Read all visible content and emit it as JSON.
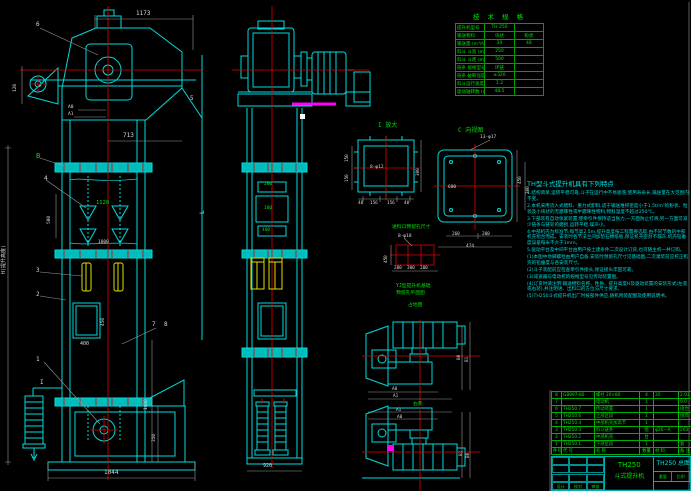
{
  "spec": {
    "title": "技 术 规 格",
    "rows": [
      [
        "提升机型号",
        "TH 250",
        ""
      ],
      [
        "输送物料",
        "块状",
        "粉状"
      ],
      [
        "输送量 (m³/h)",
        "30",
        "48"
      ],
      [
        "料斗 斗宽 (mm)",
        "250",
        ""
      ],
      [
        "料斗 斗距 (mm)",
        "500",
        ""
      ],
      [
        "链条 规格型号",
        "环链",
        ""
      ],
      [
        "链条 破断强度 (kN)",
        "≥320",
        ""
      ],
      [
        "料斗运行速度 (m/s)",
        "1.2",
        ""
      ],
      [
        "驱动轴转数 (r/min)",
        "48.5",
        ""
      ]
    ]
  },
  "notes": {
    "title": "TH型斗式提升机具有下列特点",
    "lines": [
      "1.结构简单,运转平稳可靠,斗子在运行中不易脱落,使用寿命长,输送量在大范围内不变。",
      "2.本机采用流入式喂料、重力式卸料,适于输送堆积密度小于1.5t/m³的粉状、粒状及小块状的无磨琢性或半磨琢性物料,物料温度不超过250℃。",
      "3.下部装有自动张紧装置,使牵引件保持适当张力,一方面防止打滑,另一方面可减少链条与链轮的磨损,运转平稳,噪声小。",
      "4.中部机壳为标准节,每节高2.5m,提升高度按工程需要选取,由不同节数的中部机壳组合而成。安装时各节法兰间加垫石棉纸板,保证机壳密封不漏灰,机壳铅垂度误差每米不大于1mm。",
      "5.驱动平台及中间平台由用户按土建条件二次设计订货,也可随主机一并订购。",
      "(1)本图中地脚螺栓由用户自备,安装时预留孔尺寸见基础图,二次灌浆前应校正机壳的铅垂度与各安装尺寸。",
      "(2)斗子装配前应检查牵引件接头,保证接头牢固可靠。",
      "(3)减速器与电动机的规格型号见传动装置图。",
      "(4)订货时请注明:输送物料名称、性质、提升高度H及驱动装置的安装形式(左装或右装),并注明进、出料口的方位与尺寸要求。",
      "(5)TH250斗式提升机出厂时按部件供应,随机附装配图及使用说明书。"
    ]
  },
  "bom": {
    "rows": [
      [
        "8",
        "GB897-86",
        "螺柱 20×80",
        "4",
        "35",
        "2.03"
      ],
      [
        "7",
        "",
        "电动机",
        "1",
        "",
        "9.0"
      ],
      [
        "6",
        "TH250.7",
        "传动装置",
        "1",
        "",
        "组合"
      ],
      [
        "5",
        "TH250.6",
        "上部区段",
        "1",
        "",
        "组焊"
      ],
      [
        "4",
        "TH250.4",
        "中部机壳加高节",
        "1",
        "",
        ""
      ],
      [
        "3",
        "TH250.3",
        "料斗链条",
        "组",
        "φ26—A",
        "203"
      ],
      [
        "2",
        "TH250.2",
        "中部机壳",
        "台",
        "",
        ""
      ],
      [
        "1",
        "TH250.1",
        "下部区段",
        "1",
        "",
        "套"
      ],
      [
        "件号",
        "代 号",
        "名 称",
        "数量",
        "材 料",
        "备 注"
      ]
    ]
  },
  "title_block": {
    "model": "TH250",
    "name": "斗式提升机",
    "drawing_no": "TH250 总图",
    "sign_labels": [
      "设计",
      "校对",
      "审核"
    ],
    "weight_label": "重量",
    "scale_label": "比例"
  },
  "annotations": [
    {
      "t": "6",
      "x": 36,
      "y": 22,
      "s": 6
    },
    {
      "t": "1173",
      "x": 136,
      "y": 11,
      "s": 6
    },
    {
      "t": "120",
      "x": 14,
      "y": 92,
      "s": 4.5,
      "r": -90
    },
    {
      "t": "A0",
      "x": 68,
      "y": 106,
      "s": 4.5
    },
    {
      "t": "A1",
      "x": 68,
      "y": 113,
      "s": 4.5
    },
    {
      "t": "713",
      "x": 123,
      "y": 133,
      "s": 6
    },
    {
      "t": "5",
      "x": 190,
      "y": 96,
      "s": 6
    },
    {
      "t": "B",
      "x": 36,
      "y": 153,
      "s": 7,
      "c": "#00e000"
    },
    {
      "t": "4",
      "x": 44,
      "y": 176,
      "s": 6
    },
    {
      "t": "500",
      "x": 48,
      "y": 224,
      "s": 4.5,
      "r": -90
    },
    {
      "t": "1120",
      "x": 96,
      "y": 201,
      "s": 5.5,
      "c": "#00e000"
    },
    {
      "t": "1000",
      "x": 98,
      "y": 241,
      "s": 4.5
    },
    {
      "t": "3",
      "x": 36,
      "y": 268,
      "s": 6
    },
    {
      "t": "2",
      "x": 36,
      "y": 292,
      "s": 6
    },
    {
      "t": "L",
      "x": 200,
      "y": 214,
      "s": 6,
      "r": -90
    },
    {
      "t": "H(提升高度)",
      "x": 2,
      "y": 274,
      "s": 5,
      "r": -90
    },
    {
      "t": "400",
      "x": 80,
      "y": 342,
      "s": 5
    },
    {
      "t": "450",
      "x": 102,
      "y": 326,
      "s": 4.5,
      "r": -90
    },
    {
      "t": "7",
      "x": 152,
      "y": 322,
      "s": 6
    },
    {
      "t": "8",
      "x": 164,
      "y": 322,
      "s": 6
    },
    {
      "t": "1",
      "x": 36,
      "y": 357,
      "s": 6
    },
    {
      "t": "I",
      "x": 40,
      "y": 380,
      "s": 6
    },
    {
      "t": "1400",
      "x": 145,
      "y": 410,
      "s": 4.5,
      "r": -90
    },
    {
      "t": "350",
      "x": 153,
      "y": 442,
      "s": 4.5,
      "r": -90
    },
    {
      "t": "1044",
      "x": 104,
      "y": 470,
      "s": 6
    },
    {
      "t": "260",
      "x": 264,
      "y": 183,
      "s": 4.5,
      "c": "#00e000"
    },
    {
      "t": "180",
      "x": 264,
      "y": 207,
      "s": 4.5,
      "c": "#00e000"
    },
    {
      "t": "400",
      "x": 262,
      "y": 229,
      "s": 4.5,
      "c": "#00e000"
    },
    {
      "t": "920",
      "x": 263,
      "y": 464,
      "s": 5
    },
    {
      "t": "I 放大",
      "x": 378,
      "y": 123,
      "s": 6,
      "c": "#00e000"
    },
    {
      "t": "8-φ12",
      "x": 370,
      "y": 166,
      "s": 4.5
    },
    {
      "t": "150",
      "x": 346,
      "y": 162,
      "s": 4.3,
      "r": -90
    },
    {
      "t": "150",
      "x": 346,
      "y": 182,
      "s": 4.3,
      "r": -90
    },
    {
      "t": "300",
      "x": 417,
      "y": 176,
      "s": 4.3,
      "r": -90
    },
    {
      "t": "40",
      "x": 358,
      "y": 202,
      "s": 4.3
    },
    {
      "t": "156",
      "x": 370,
      "y": 202,
      "s": 4.3
    },
    {
      "t": "156",
      "x": 387,
      "y": 202,
      "s": 4.3
    },
    {
      "t": "40",
      "x": 404,
      "y": 202,
      "s": 4.3
    },
    {
      "t": "C 向视图",
      "x": 458,
      "y": 128,
      "s": 6,
      "c": "#00e000"
    },
    {
      "t": "13-φ17",
      "x": 480,
      "y": 136,
      "s": 4.5
    },
    {
      "t": "600",
      "x": 448,
      "y": 186,
      "s": 4.5
    },
    {
      "t": "450",
      "x": 519,
      "y": 184,
      "s": 4.3,
      "r": -90
    },
    {
      "t": "300",
      "x": 527,
      "y": 194,
      "s": 4.3,
      "r": -90
    },
    {
      "t": "260",
      "x": 452,
      "y": 233,
      "s": 4.3
    },
    {
      "t": "200",
      "x": 482,
      "y": 233,
      "s": 4.3
    },
    {
      "t": "474",
      "x": 466,
      "y": 245,
      "s": 4.5
    },
    {
      "t": "进料口预留孔尺寸",
      "x": 392,
      "y": 226,
      "s": 4.8,
      "c": "#00e000"
    },
    {
      "t": "8-φ18",
      "x": 398,
      "y": 235,
      "s": 4.5
    },
    {
      "t": "450",
      "x": 385,
      "y": 263,
      "s": 4.3,
      "r": -90
    },
    {
      "t": "200",
      "x": 394,
      "y": 267,
      "s": 4.3
    },
    {
      "t": "300",
      "x": 407,
      "y": 267,
      "s": 4.3
    },
    {
      "t": "200",
      "x": 420,
      "y": 267,
      "s": 4.3
    },
    {
      "t": "YJ型提升机基础",
      "x": 396,
      "y": 285,
      "s": 4.8,
      "c": "#00e000"
    },
    {
      "t": "预留孔平面图",
      "x": 396,
      "y": 292,
      "s": 4.8,
      "c": "#00e000"
    },
    {
      "t": "占地图",
      "x": 408,
      "y": 304,
      "s": 4.8,
      "c": "#00e000"
    },
    {
      "t": "B0",
      "x": 458,
      "y": 360,
      "s": 4.3,
      "r": -90
    },
    {
      "t": "B1",
      "x": 466,
      "y": 362,
      "s": 4.3,
      "r": -90
    },
    {
      "t": "A0",
      "x": 392,
      "y": 388,
      "s": 4.3
    },
    {
      "t": "A1",
      "x": 393,
      "y": 395,
      "s": 4.3
    },
    {
      "t": "右装",
      "x": 413,
      "y": 403,
      "s": 4.8,
      "c": "#00e000"
    },
    {
      "t": "A1",
      "x": 396,
      "y": 409,
      "s": 4.3
    },
    {
      "t": "A0",
      "x": 397,
      "y": 416,
      "s": 4.3
    },
    {
      "t": "B1",
      "x": 460,
      "y": 456,
      "s": 4.3,
      "r": -90
    },
    {
      "t": "B0",
      "x": 467,
      "y": 458,
      "s": 4.3,
      "r": -90
    }
  ]
}
